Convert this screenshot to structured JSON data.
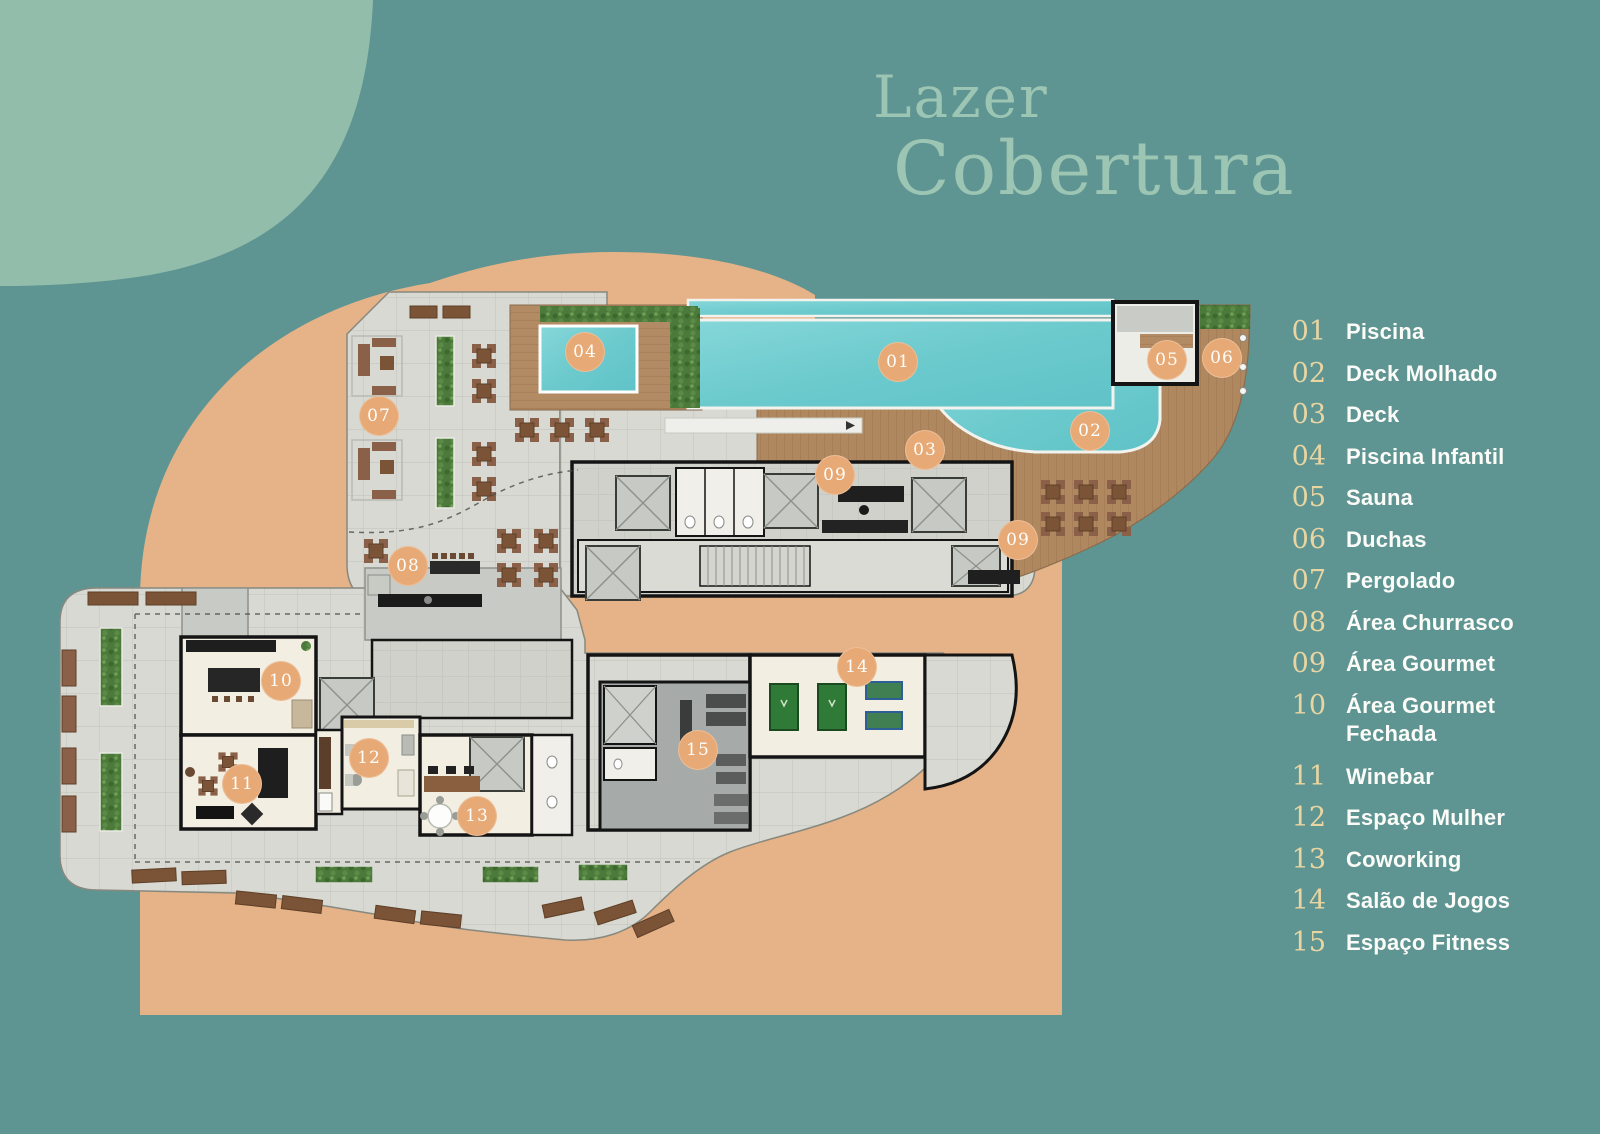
{
  "title": {
    "line1": "Lazer",
    "line2": "Cobertura"
  },
  "legend": {
    "items": [
      {
        "num": "01",
        "label": "Piscina"
      },
      {
        "num": "02",
        "label": "Deck Molhado"
      },
      {
        "num": "03",
        "label": "Deck"
      },
      {
        "num": "04",
        "label": "Piscina Infantil"
      },
      {
        "num": "05",
        "label": "Sauna"
      },
      {
        "num": "06",
        "label": "Duchas"
      },
      {
        "num": "07",
        "label": "Pergolado"
      },
      {
        "num": "08",
        "label": "Área Churrasco"
      },
      {
        "num": "09",
        "label": "Área Gourmet"
      },
      {
        "num": "10",
        "label": "Área Gourmet Fechada"
      },
      {
        "num": "11",
        "label": "Winebar"
      },
      {
        "num": "12",
        "label": "Espaço Mulher"
      },
      {
        "num": "13",
        "label": "Coworking"
      },
      {
        "num": "14",
        "label": "Salão de Jogos"
      },
      {
        "num": "15",
        "label": "Espaço Fitness"
      }
    ]
  },
  "colors": {
    "background_teal": "#5E9592",
    "sage_shape": "#93BDAB",
    "peach_shape": "#E6B287",
    "title_text": "#9CC5B3",
    "legend_number": "#E9D5A1",
    "legend_label": "#FBFBF8",
    "marker_fill": "#E7A975",
    "pool_water": "#74CCCF",
    "wood_deck": "#B08860",
    "tile_paving": "#D7D9D2"
  }
}
